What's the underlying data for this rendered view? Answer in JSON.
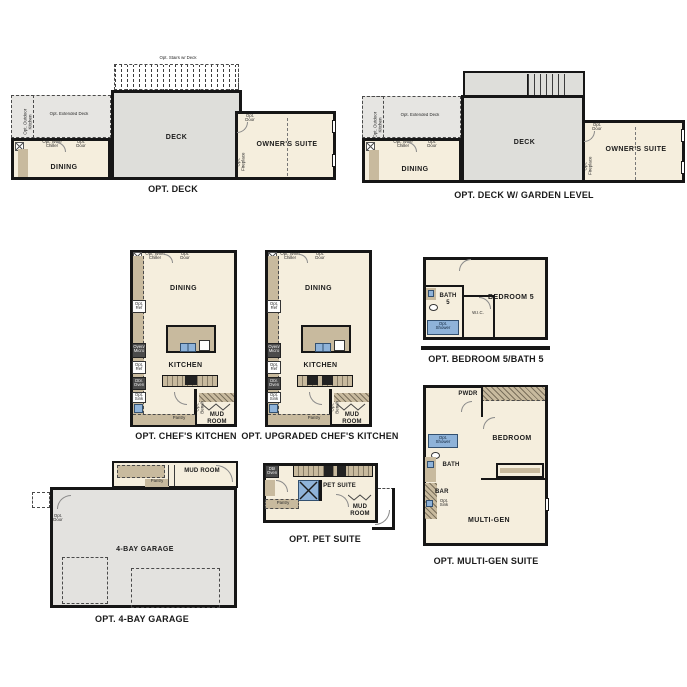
{
  "colors": {
    "wall": "#161616",
    "room_fill": "#f5eedd",
    "deck_fill": "#dededa",
    "extended_deck_fill": "#e6e5e2",
    "cabinet_fill": "#c8ba9e",
    "fixture_blue": "#8fb3d9"
  },
  "plan_deck": {
    "caption": "OPT. DECK",
    "stairs": "Opt. Stairs w/ Deck",
    "extended_deck": "Opt. Extended Deck",
    "outdoor_kitchen": "Opt. Outdoor Kitchen",
    "deck": "DECK",
    "wine_chiller": "Opt. Wine Chiller",
    "door": "Opt. Door",
    "dining": "DINING",
    "owners_door": "Opt. Door",
    "fireplace": "Opt. Fireplace",
    "owners_suite": "OWNER'S SUITE"
  },
  "plan_deck_garden": {
    "caption": "OPT. DECK W/ GARDEN LEVEL",
    "extended_deck": "Opt. Extended Deck",
    "outdoor_kitchen": "Opt. Outdoor Kitchen",
    "deck": "DECK",
    "wine_chiller": "Opt. Wine Chiller",
    "door": "Opt. Door",
    "dining": "DINING",
    "owners_door": "Opt. Door",
    "fireplace": "Opt. Fireplace",
    "owners_suite": "OWNER'S SUITE"
  },
  "plan_chefs": {
    "caption": "OPT. CHEF'S KITCHEN",
    "wine_chiller": "Opt. Wine Chiller",
    "door": "Opt. Door",
    "dining": "DINING",
    "kitchen": "KITCHEN",
    "opt_ref_1": "Opt. Ref",
    "oven_micro": "Oven/ Micro",
    "opt_ref_2": "Opt. Ref",
    "dbl_oven": "Dbl. Oven",
    "opt_sink": "Opt. Sink",
    "pantry": "Pantry",
    "opt_bench": "Opt. Bench",
    "mud_room": "MUD ROOM"
  },
  "plan_upgraded": {
    "caption": "OPT. UPGRADED CHEF'S KITCHEN",
    "wine_chiller": "Opt. Wine Chiller",
    "door": "Opt. Door",
    "dining": "DINING",
    "kitchen": "KITCHEN",
    "opt_ref_1": "Opt. Ref",
    "oven_micro": "Oven/ Micro",
    "opt_ref_2": "Opt. Ref",
    "dbl_oven": "Dbl. Oven",
    "opt_sink": "Opt. Sink",
    "pantry": "Pantry",
    "opt_bench": "Opt. Bench",
    "mud_room": "MUD ROOM"
  },
  "plan_bedroom5": {
    "caption": "OPT. BEDROOM 5/BATH 5",
    "bedroom": "BEDROOM 5",
    "bath": "BATH 5",
    "wic": "W.I.C.",
    "opt_shower": "Opt. Shower"
  },
  "plan_multigen": {
    "caption": "OPT. MULTI-GEN SUITE",
    "pwdr": "PWDR",
    "opt_shower": "Opt. Shower",
    "bath": "BATH",
    "bedroom": "BEDROOM",
    "bar": "BAR",
    "opt_sink": "Opt. Sink",
    "multi_gen": "MULTI-GEN"
  },
  "plan_garage": {
    "caption": "OPT. 4-BAY GARAGE",
    "pantry": "Pantry",
    "mud_room": "MUD ROOM",
    "opt_door": "Opt. Door",
    "garage": "4-BAY GARAGE"
  },
  "plan_pet": {
    "caption": "OPT. PET SUITE",
    "dbl_oven": "Dbl Oven",
    "pet_suite": "PET SUITE",
    "pantry": "Pantry",
    "mud_room": "MUD ROOM"
  }
}
